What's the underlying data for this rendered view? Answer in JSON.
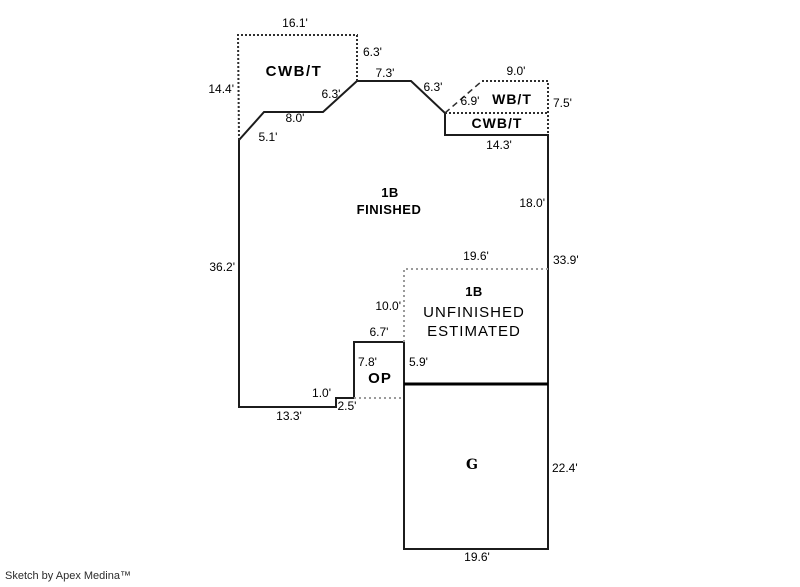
{
  "sketch": {
    "credit": "Sketch by Apex Medina™",
    "colors": {
      "wall": "#1c1c1c",
      "interior_wall": "#000000",
      "basement_dotted": "#2e2e2e",
      "estimate_dotted": "#9a9a9a",
      "text": "#000000"
    },
    "areas": {
      "cwbt_upper": "CWB/T",
      "wbt": "WB/T",
      "cwbt_right": "CWB/T",
      "finished_l1": "1B",
      "finished_l2": "FINISHED",
      "unfinished_l1": "1B",
      "unfinished_l2": "UNFINISHED",
      "unfinished_l3": "ESTIMATED",
      "op": "OP",
      "garage": "G"
    },
    "dims": {
      "cwbt_top": "16.1'",
      "cwbt_right": "6.3'",
      "cwbt_left": "14.4'",
      "ridge_top": "7.3'",
      "diag_left_upper": "6.3'",
      "step_8": "8.0'",
      "diag_left_lower": "5.1'",
      "diag_right": "6.3'",
      "wbt_diag": "6.9'",
      "wbt_top": "9.0'",
      "wbt_right": "7.5'",
      "cwbt_right_width": "14.3'",
      "right_upper": "18.0'",
      "left_main": "36.2'",
      "unf_top": "19.6'",
      "right_lower": "33.9'",
      "unf_left": "10.0'",
      "op_top": "6.7'",
      "op_left": "7.8'",
      "op_right": "5.9'",
      "step_1": "1.0'",
      "step_2": "2.5'",
      "bottom_left": "13.3'",
      "gar_right": "22.4'",
      "gar_bottom": "19.6'"
    }
  }
}
